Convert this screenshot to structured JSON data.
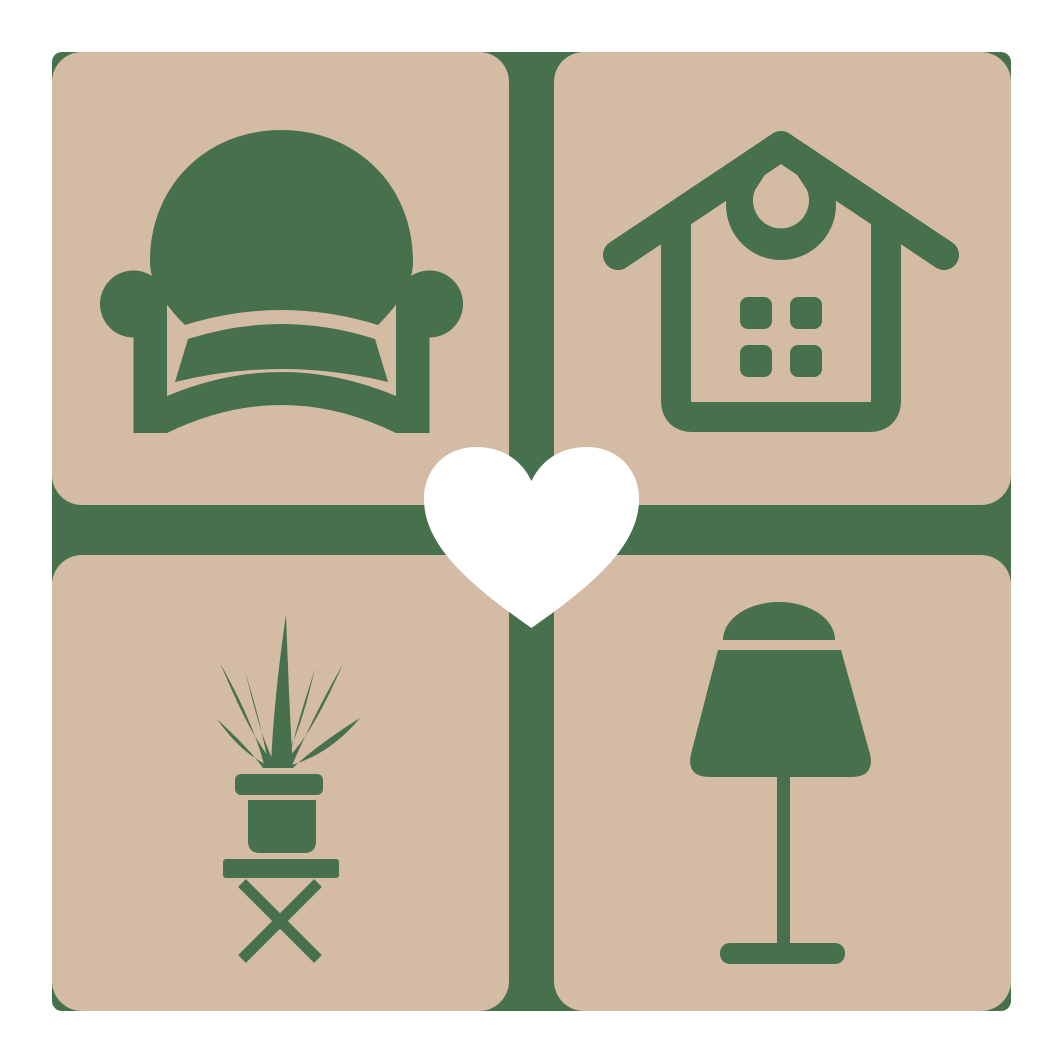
{
  "logo": {
    "colors": {
      "page_background": "#FFFFFF",
      "tile": "#D3BBA4",
      "icon_green": "#47704D",
      "heart": "#FFFFFF"
    },
    "tiles": [
      {
        "name": "armchair",
        "position": "top-left"
      },
      {
        "name": "house",
        "position": "top-right"
      },
      {
        "name": "potted-plant",
        "position": "bottom-left"
      },
      {
        "name": "table-lamp",
        "position": "bottom-right"
      }
    ],
    "center": {
      "name": "heart"
    }
  }
}
